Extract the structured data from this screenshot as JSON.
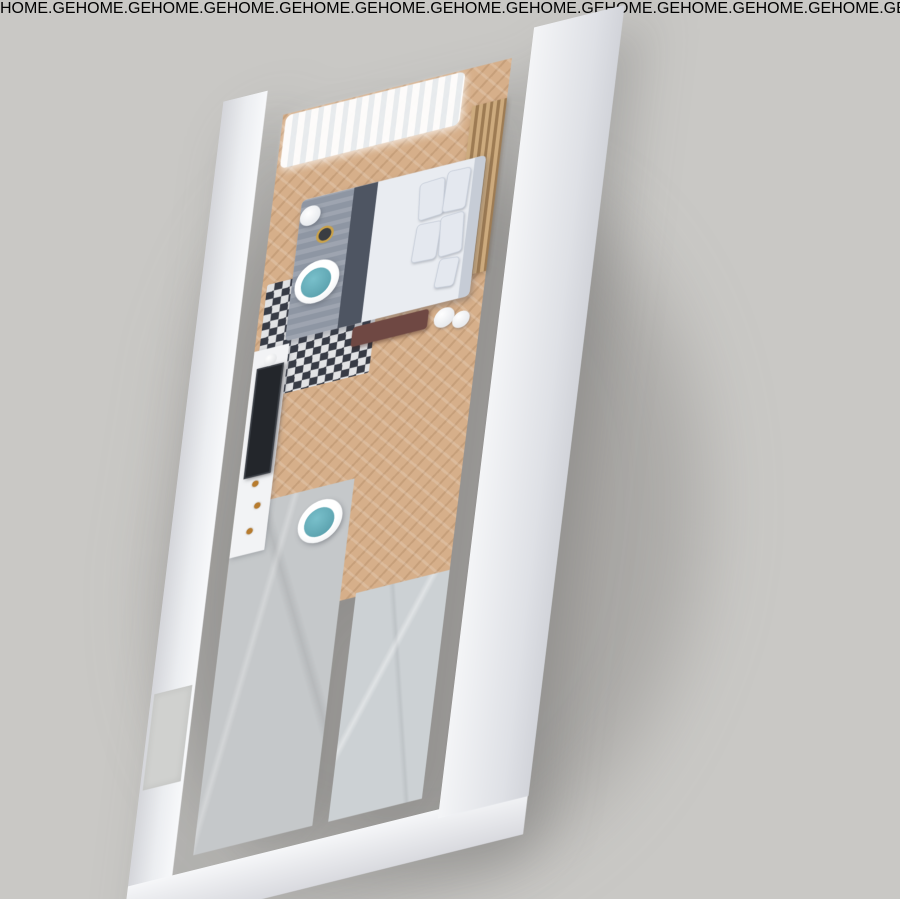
{
  "watermark": {
    "text": "HOME.GE"
  },
  "scene": {
    "type": "3d-floor-plan-render",
    "background_color": "#c9c8c5",
    "palette": {
      "wall_white": "#f3f4f6",
      "wall_face_shadow": "#d4d5da",
      "wood_floor": "#d6af8a",
      "balcony_wood": "#bd9a74",
      "slat_screen_brown": "#8a6a4c",
      "slat_partition_gold": "#cdab7e",
      "railing_black": "#26292d",
      "curtain_white": "#ffffff",
      "bed_duvet": "#e9ecf1",
      "bed_blanket_gray": "#8e96a3",
      "bed_throw_charcoal": "#4e5562",
      "bench_maroon": "#6f4843",
      "sofa_maroon": "#6f4641",
      "chair_teal": "#79c0cb",
      "round_rug_gray": "#8a99a7",
      "chevron_rug_navy": "#2f3542",
      "tv_black": "#23262b",
      "copper_tile": "#d9a085",
      "counter_white": "#eef0f2",
      "vanity_slate": "#39424a",
      "drawer_wood": "#a97f52",
      "corridor_concrete": "#c5c8ca",
      "bath_tile_gray": "#ccd1d4",
      "clothes_navy": "#3d5a94",
      "clothes_gold": "#b98e3f",
      "accent_amber": "#b77b2e",
      "vase_pink": "#c98b92"
    },
    "rooms": [
      {
        "name": "balcony"
      },
      {
        "name": "bedroom"
      },
      {
        "name": "living-area"
      },
      {
        "name": "kitchenette"
      },
      {
        "name": "hallway"
      },
      {
        "name": "wardrobe"
      },
      {
        "name": "bathroom"
      }
    ],
    "furniture": [
      "balcony-railing",
      "wood-slat-screen",
      "sheer-curtains",
      "slat-partition",
      "double-bed",
      "pillows",
      "bed-bench",
      "chevron-rug",
      "floor-lamp",
      "teal-accent-chairs",
      "tv",
      "tv-console",
      "round-rug",
      "coffee-table",
      "maroon-sofa",
      "kitchen-counter",
      "copper-backsplash",
      "hallway-console",
      "stool",
      "open-wardrobe-with-clothes",
      "vanity-with-sink",
      "wood-drawers",
      "bath-mat",
      "glass-shower",
      "wall-niche"
    ]
  }
}
